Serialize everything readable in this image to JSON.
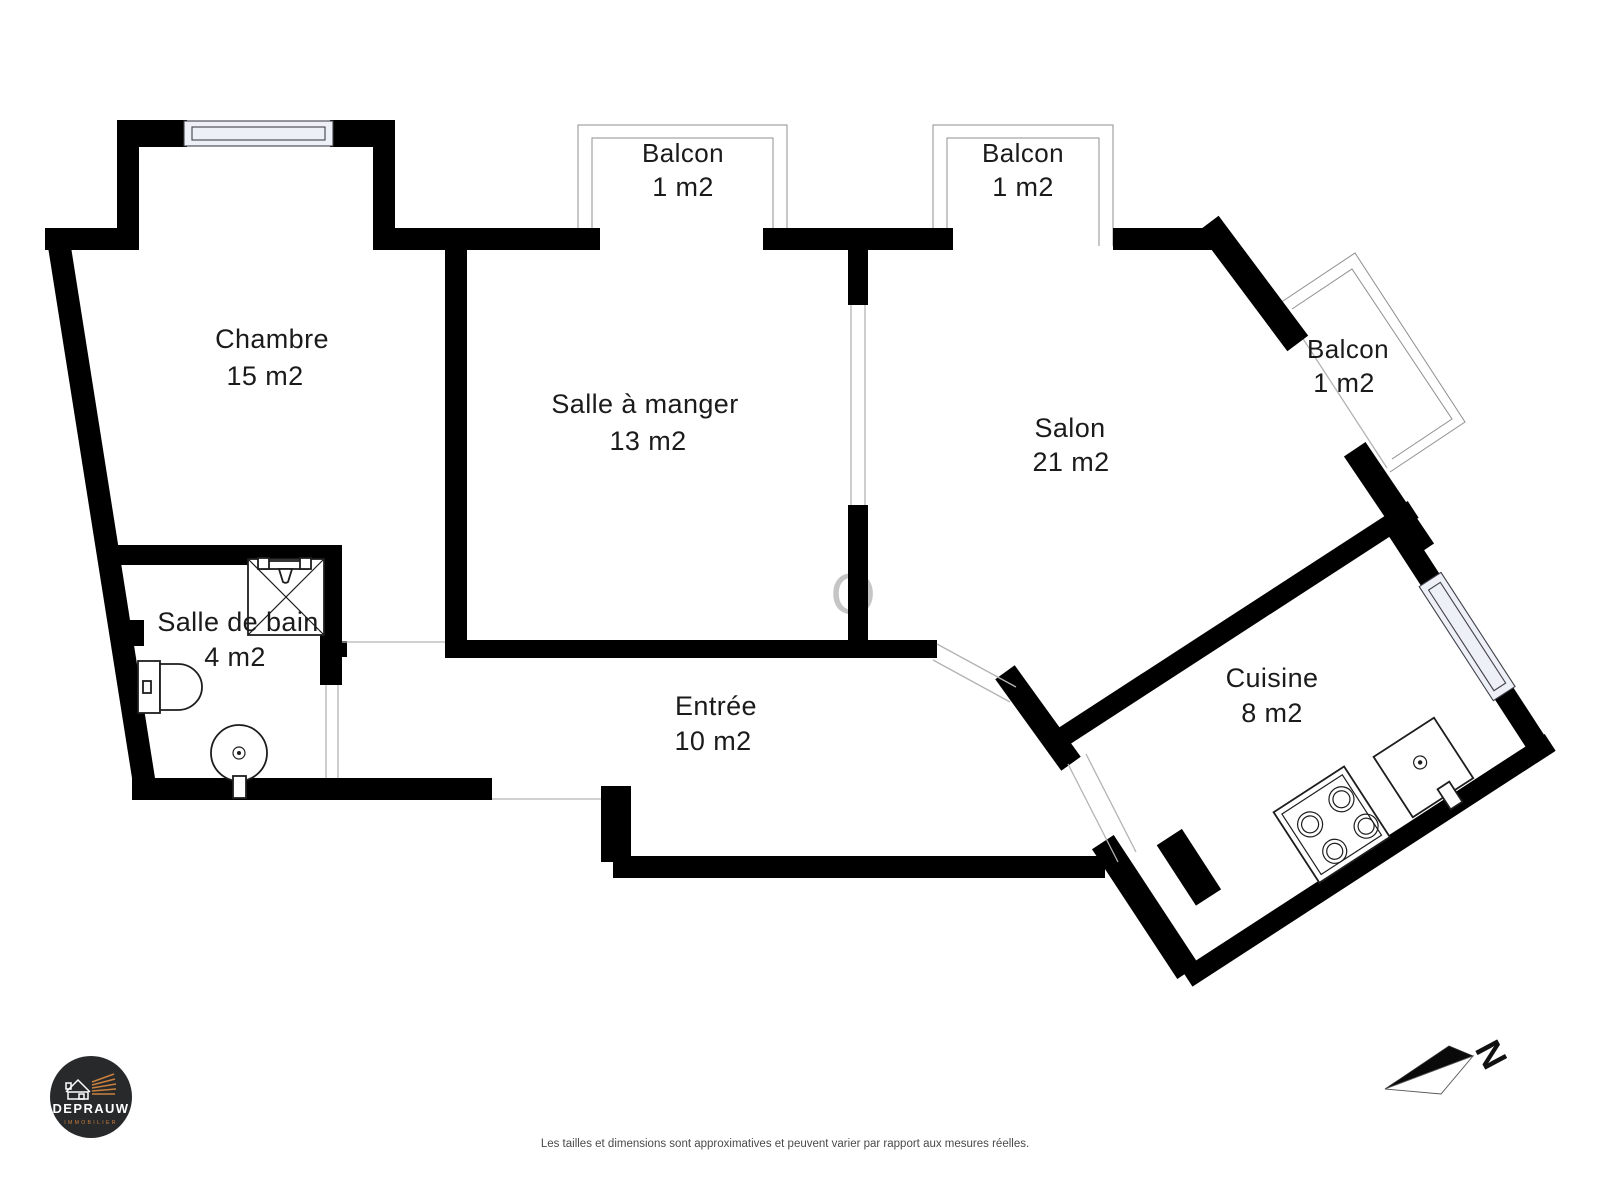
{
  "plan": {
    "rooms": {
      "chambre": {
        "name": "Chambre",
        "area": "15 m2"
      },
      "salle_a_manger": {
        "name": "Salle à manger",
        "area": "13 m2"
      },
      "salon": {
        "name": "Salon",
        "area": "21 m2"
      },
      "salle_de_bain": {
        "name": "Salle de bain",
        "area": "4 m2"
      },
      "entree": {
        "name": "Entrée",
        "area": "10 m2"
      },
      "cuisine": {
        "name": "Cuisine",
        "area": "8 m2"
      },
      "balcon1": {
        "name": "Balcon",
        "area": "1 m2"
      },
      "balcon2": {
        "name": "Balcon",
        "area": "1 m2"
      },
      "balcon3": {
        "name": "Balcon",
        "area": "1 m2"
      }
    },
    "fixtures": {
      "bathroom": [
        "shower",
        "toilet",
        "washbasin"
      ],
      "kitchen": [
        "stove",
        "sink"
      ]
    },
    "watermark": "O"
  },
  "compass": {
    "label": "N"
  },
  "logo": {
    "brand": "DEPRAUW",
    "tagline": "IMMOBILIER"
  },
  "footer": {
    "disclaimer": "Les tailles et dimensions sont approximatives et peuvent varier par rapport aux mesures réelles."
  },
  "colors": {
    "wall": "#000000",
    "window_fill": "#edf0f7",
    "accent_orange": "#c9803f",
    "logo_background": "#27292b",
    "thin_line": "#b3b3b3",
    "label_text": "#1b1b1b"
  }
}
